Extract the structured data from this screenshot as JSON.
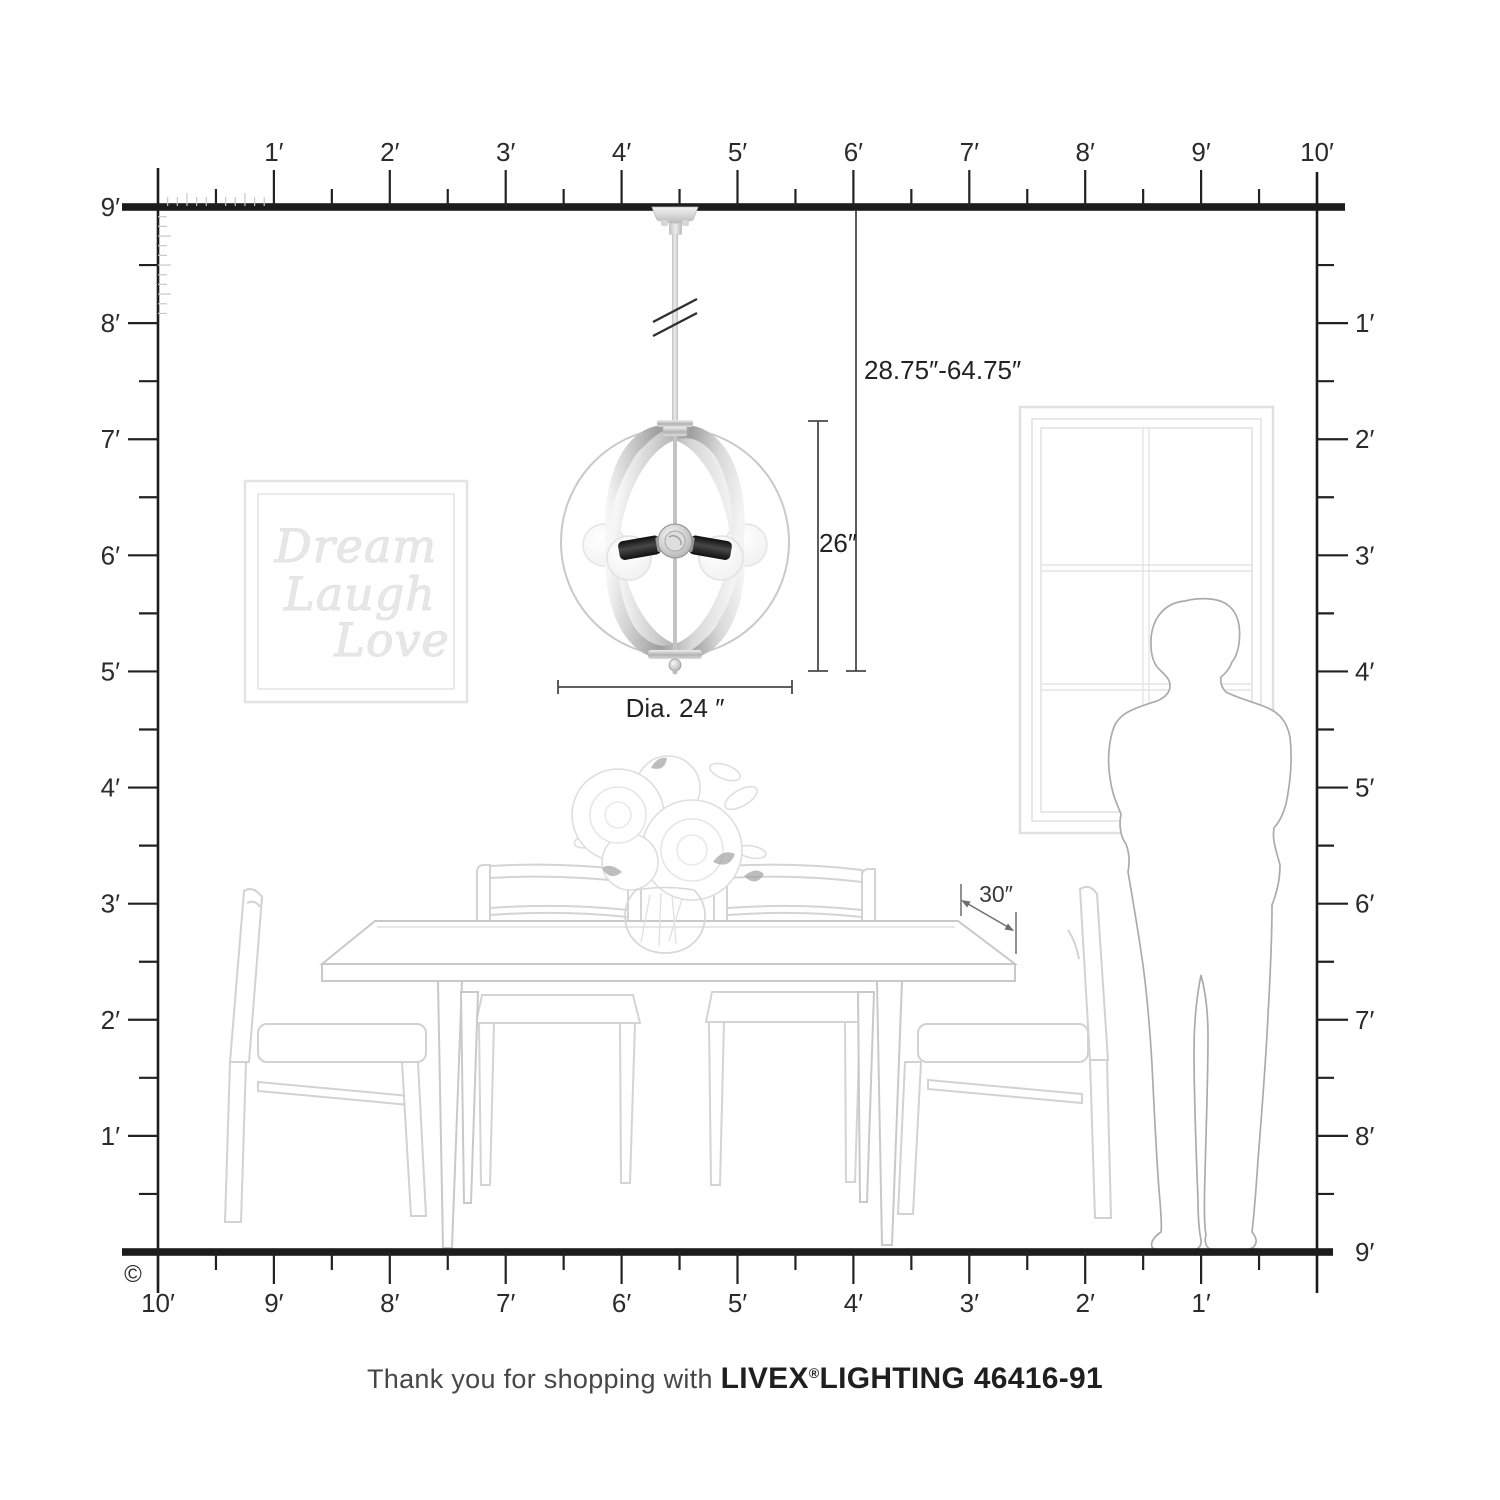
{
  "rulers": {
    "top": {
      "labels": [
        "1′",
        "2′",
        "3′",
        "4′",
        "5′",
        "6′",
        "7′",
        "8′",
        "9′",
        "10′"
      ]
    },
    "left": {
      "labels": [
        "9′",
        "8′",
        "7′",
        "6′",
        "5′",
        "4′",
        "3′",
        "2′",
        "1′"
      ]
    },
    "right": {
      "labels": [
        "1′",
        "2′",
        "3′",
        "4′",
        "5′",
        "6′",
        "7′",
        "8′",
        "9′"
      ]
    },
    "bottom": {
      "labels": [
        "10′",
        "9′",
        "8′",
        "7′",
        "6′",
        "5′",
        "4′",
        "3′",
        "2′",
        "1′"
      ]
    }
  },
  "dimensions": {
    "hang_range": "28.75″-64.75″",
    "fixture_height": "26″",
    "diameter": "Dia. 24 ″",
    "table_clearance": "30″"
  },
  "wall_art": {
    "lines": [
      "Dream",
      "Laugh",
      "Love"
    ]
  },
  "caption": {
    "prefix": "Thank you for shopping with ",
    "brand": "LIVEX",
    "registered": "®",
    "product": "LIGHTING 46416-91"
  },
  "copyright": "©",
  "colors": {
    "ruler": "#1c1c1c",
    "dimension_line": "#4a4a4c",
    "dimension_text": "#232323",
    "furniture_line": "#d2d2d2",
    "person_line": "#ababab",
    "accent_leaf": "#a2a2a2",
    "metal_dark": "#9e9e9e",
    "socket_black": "#161616"
  }
}
